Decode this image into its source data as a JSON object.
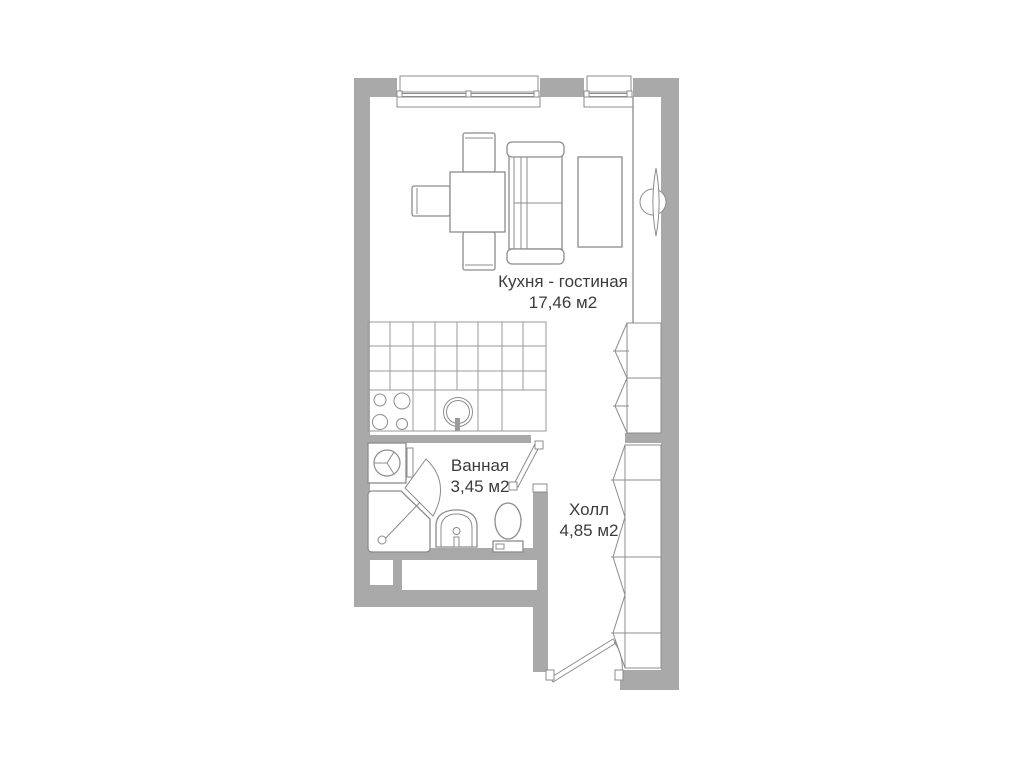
{
  "page": {
    "background": "#ffffff",
    "type": "apartment-floor-plan"
  },
  "colors": {
    "bg": "#ffffff",
    "wall": "#a9a9a9",
    "outline": "#8c8c8c",
    "grid": "#9a9a9a",
    "text": "#3c3c3c"
  },
  "rooms": [
    {
      "id": "kitchen-living-room",
      "name": "Кухня - гостиная",
      "area": "17,46 м2"
    },
    {
      "id": "bathroom",
      "name": "Ванная",
      "area": "3,45 м2"
    },
    {
      "id": "hall",
      "name": "Холл",
      "area": "4,85 м2"
    }
  ],
  "fixtures": [
    "window-large",
    "window-small",
    "dining-table",
    "chair-top",
    "chair-left",
    "chair-bottom",
    "sofa",
    "tv-stand",
    "radiator",
    "kitchen-cabinets-grid",
    "kitchen-counter",
    "stove-burners",
    "kitchen-sink",
    "kitchen-closet",
    "washing-machine",
    "shower-tray",
    "shower-door",
    "washbasin",
    "toilet",
    "bathroom-door",
    "hall-wardrobe",
    "entrance-door",
    "wall-niches"
  ]
}
